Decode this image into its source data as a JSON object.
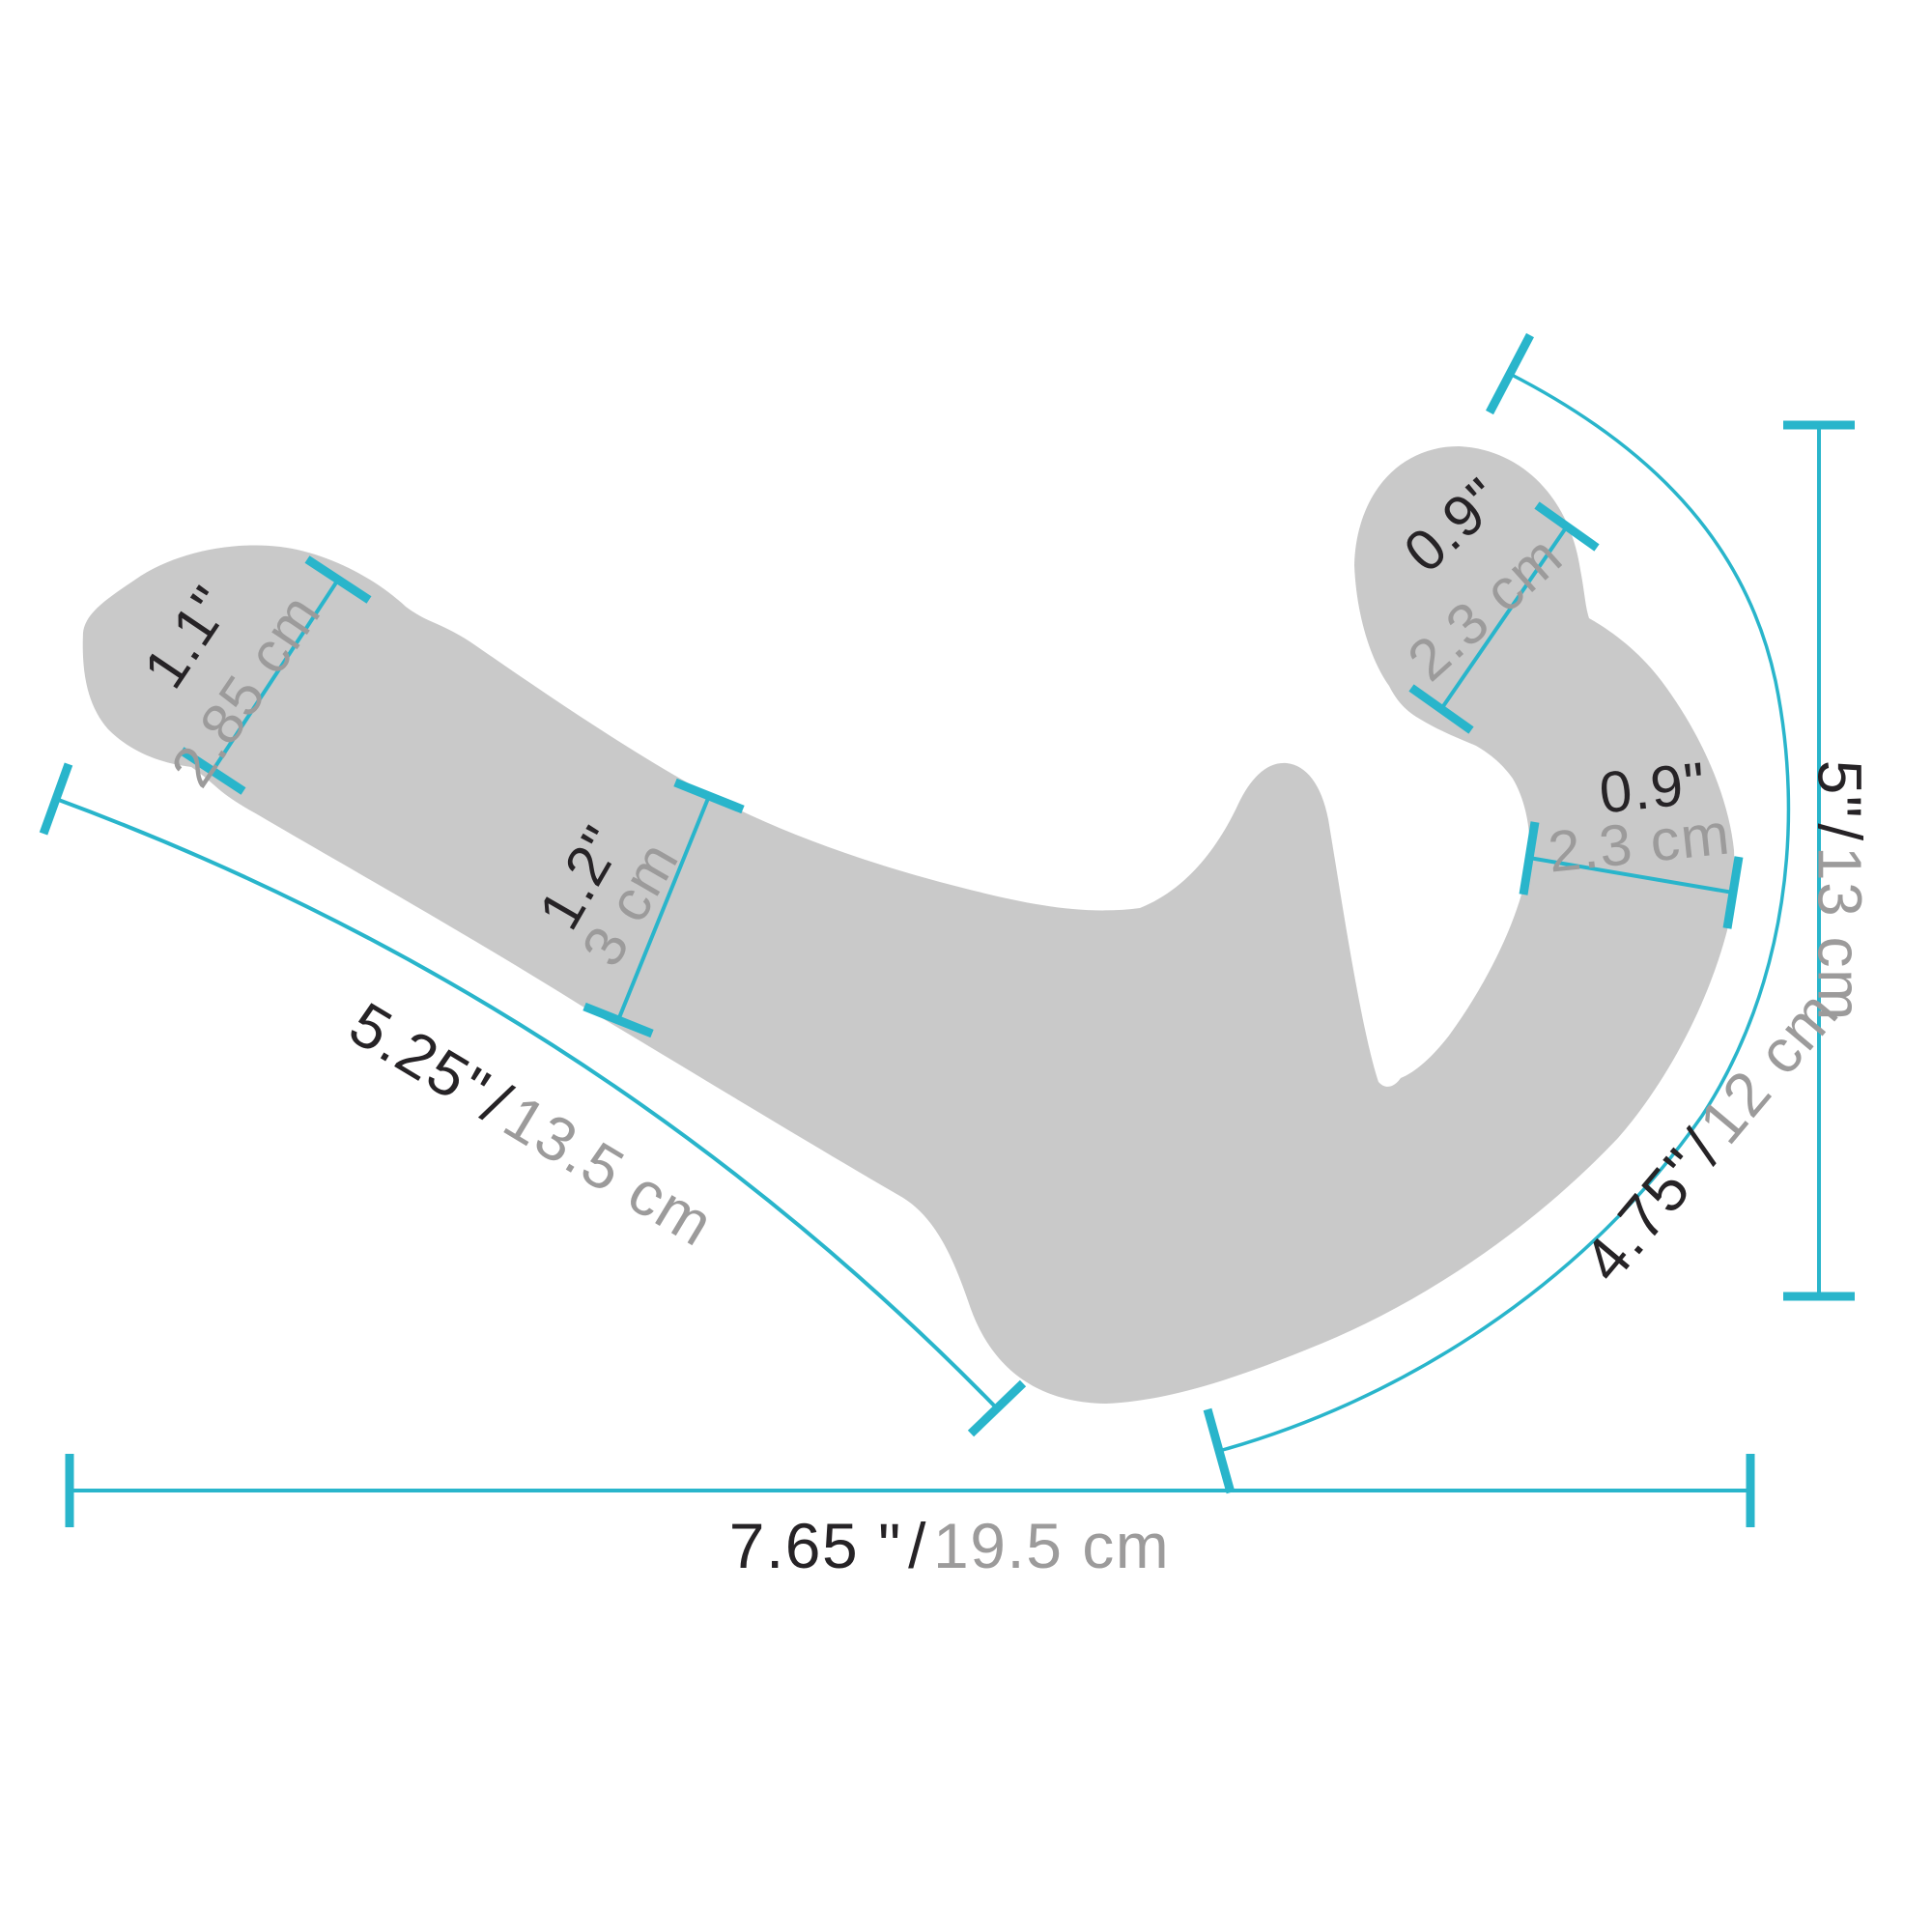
{
  "colors": {
    "silhouette": "#c9c9c9",
    "accent": "#29b5cb",
    "label_dark": "#262326",
    "label_gray": "#9c9b9b",
    "background": "#ffffff"
  },
  "measurements": {
    "tip_width": {
      "imperial": "1.1\"",
      "metric": "2.85 cm"
    },
    "shaft_width": {
      "imperial": "1.2\"",
      "metric": "3 cm"
    },
    "shaft_length": {
      "imperial": "5.25\"",
      "separator": "/",
      "metric": "13.5 cm"
    },
    "total_length": {
      "imperial": "7.65 \"",
      "separator": "/",
      "metric": "19.5 cm"
    },
    "overall_height": {
      "imperial": "5\"",
      "separator": "/",
      "metric": "13 cm"
    },
    "curve_length": {
      "imperial": "4.75\"",
      "separator": "/",
      "metric": "12 cm"
    },
    "bulb_width": {
      "imperial": "0.9\"",
      "metric": "2.3 cm"
    },
    "bulb_shaft_width": {
      "imperial": "0.9\"",
      "metric": "2.3 cm"
    }
  }
}
